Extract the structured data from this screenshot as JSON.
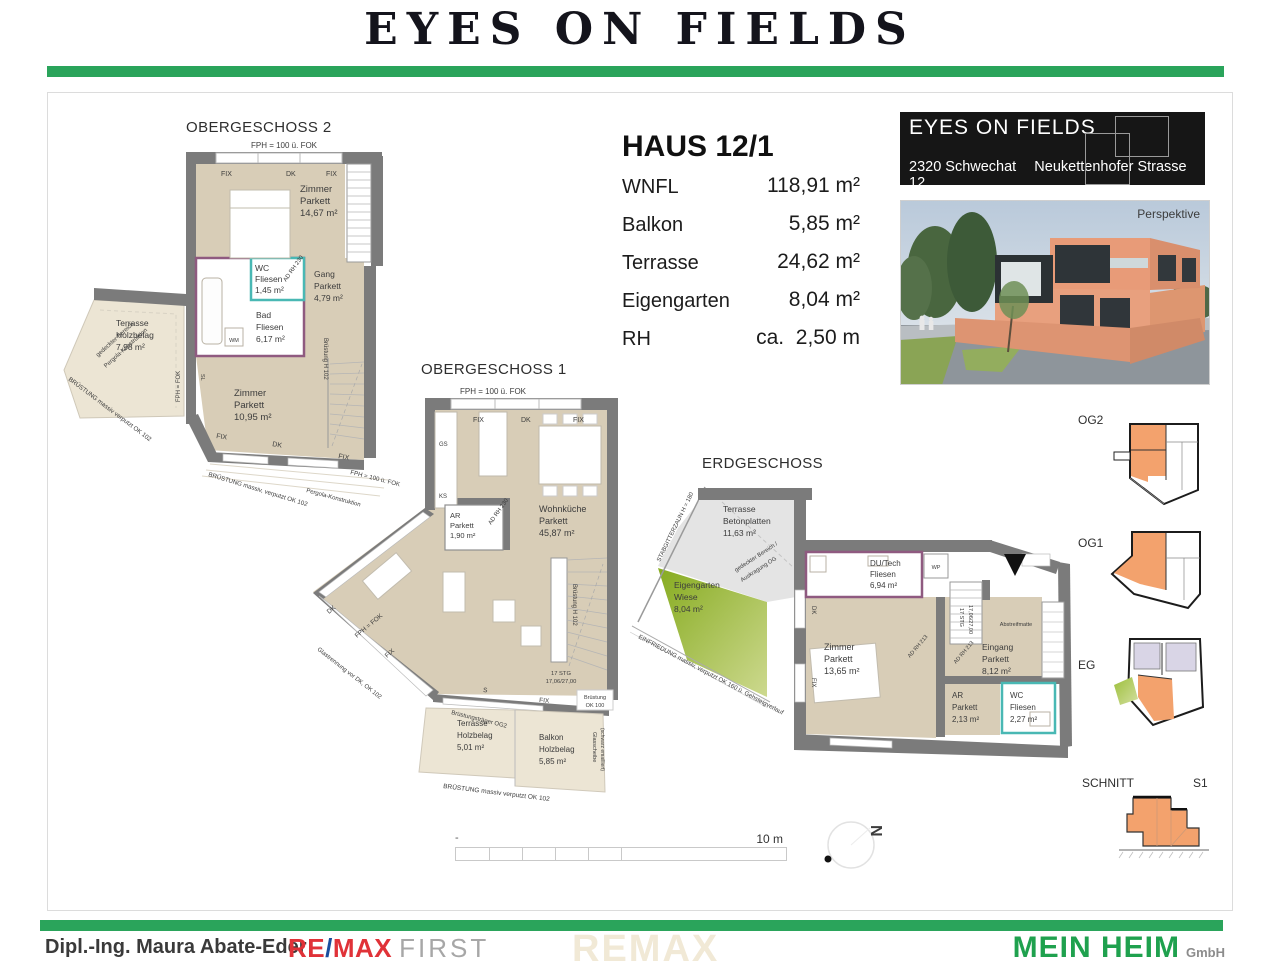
{
  "header": {
    "title": "EYES ON FIELDS"
  },
  "unit": {
    "title": "HAUS 12/1",
    "rows": [
      {
        "label": "WNFL",
        "value": "118,91 m²"
      },
      {
        "label": "Balkon",
        "value": "5,85 m²"
      },
      {
        "label": "Terrasse",
        "value": "24,62 m²"
      },
      {
        "label": "Eigengarten",
        "value": "8,04 m²"
      },
      {
        "label": "RH",
        "value": "ca.  2,50 m"
      }
    ]
  },
  "project": {
    "name": "EYES ON FIELDS",
    "city": "2320 Schwechat",
    "street": "Neukettenhofer Strasse 12",
    "perspective_label": "Perspektive"
  },
  "plans": {
    "og2": {
      "title": "OBERGESCHOSS 2",
      "a": {
        "fph_100": "FPH = 100 ü. FOK",
        "fix": "FIX",
        "dk": "DK",
        "zimmer1": [
          "Zimmer",
          "Parkett",
          "14,67 m²"
        ],
        "wc": [
          "WC",
          "Fliesen",
          "1,45 m²"
        ],
        "ad_rh_230": "AD RH 230",
        "bad": [
          "Bad",
          "Fliesen",
          "6,17 m²"
        ],
        "wm": "WM",
        "gang": [
          "Gang",
          "Parkett",
          "4,79 m²"
        ],
        "bruestung_h102": "Brüstung H 102",
        "zimmer2": [
          "Zimmer",
          "Parkett",
          "10,95 m²"
        ],
        "terrasse": [
          "Terrasse",
          "Holzbelag",
          "7,98 m²"
        ],
        "gedeckter": [
          "gedeckter Bereich",
          "Pergola-Konstruktion"
        ],
        "bruestung1": "BRÜSTUNG massiv verputzt OK 102",
        "fph_fok": "FPH = FOK",
        "sl": "SL",
        "bruestung2": "BRÜSTUNG massiv, verputzt OK 102",
        "pergola": "Pergola-Konstruktion"
      }
    },
    "og1": {
      "title": "OBERGESCHOSS 1",
      "a": {
        "fph_100": "FPH = 100 ü. FOK",
        "fix": "FIX",
        "dk": "DK",
        "gs": "GS",
        "ks": "KS",
        "ar": [
          "AR",
          "Parkett",
          "1,90 m²"
        ],
        "ad_rh_230": "AD RH 230",
        "wohnkueche": [
          "Wohnküche",
          "Parkett",
          "45,87 m²"
        ],
        "bruestung_h102": "Brüstung H 102",
        "stg": [
          "17 STG",
          "17,06/27,00"
        ],
        "glastrennung": "Glastrennung vor DK, OK 102",
        "fph_fok": "FPH = FOK",
        "s": "S",
        "bruestung_ok100": [
          "Brüstung",
          "OK 100"
        ],
        "bruestungstraeger": "Brüstungsträger OG2",
        "terrasse": [
          "Terrasse",
          "Holzbelag",
          "5,01 m²"
        ],
        "balkon": [
          "Balkon",
          "Holzbelag",
          "5,85 m²"
        ],
        "glasscheibe": [
          "Glasscheibe",
          "(schwarz emailliert)"
        ],
        "bruestung1": "BRÜSTUNG massiv verputzt OK 102"
      }
    },
    "eg": {
      "title": "ERDGESCHOSS",
      "a": {
        "terrasse": [
          "Terrasse",
          "Betonplatten",
          "11,63 m²"
        ],
        "stabgitterzaun": "STABGITTERZAUN H = 180",
        "eigengarten": [
          "Eigengarten",
          "Wiese",
          "8,04 m²"
        ],
        "gedeckter": [
          "gedeckter Bereich /",
          "Auskragung OG"
        ],
        "einfriedung": "EINFRIEDUNG massiv, verputzt  OK 160 ü. Gehsteigverlauf",
        "dutech": [
          "DU/Tech",
          "Fliesen",
          "6,94 m²"
        ],
        "wp": "WP",
        "zimmer": [
          "Zimmer",
          "Parkett",
          "13,65 m²"
        ],
        "dk": "DK",
        "fix": "FIX",
        "stg": [
          "17 STG",
          "17,06/27,00"
        ],
        "ad_rh_213": "AD RH 213",
        "eingang": [
          "Eingang",
          "Parkett",
          "8,12 m²"
        ],
        "abstreifmatte": "Abstreifmatte",
        "ar": [
          "AR",
          "Parkett",
          "2,13 m²"
        ],
        "wc": [
          "WC",
          "Fliesen",
          "2,27 m²"
        ]
      }
    }
  },
  "overview": {
    "og2": "OG2",
    "og1": "OG1",
    "eg": "EG",
    "schnitt": "SCHNITT",
    "s1": "S1"
  },
  "scale": {
    "dash": "-",
    "label": "10 m"
  },
  "north": {
    "letter": "N"
  },
  "footer": {
    "agent": "Dipl.-Ing. Maura Abate-Eder",
    "remax_re": "RE",
    "remax_slash": "/",
    "remax_max": "MAX",
    "remax_first": "FIRST",
    "watermark": "REMAX",
    "brand": "MEIN HEIM",
    "brand_suffix": "GmbH"
  },
  "colors": {
    "accent_green": "#2aa45b",
    "brand_green": "#1fa14e",
    "remax_red": "#e03238",
    "remax_blue": "#1a4e9e",
    "floor_beige": "#d8cdb7",
    "terrace_beige": "#ece5d4",
    "wall_gray": "#7b7b7b",
    "wc_teal": "#49b8b4",
    "bath_purple": "#8f5a80",
    "garden_green": "#8db629",
    "mini_orange": "#f3a26d",
    "mini_lavender": "#d9d5e6"
  }
}
